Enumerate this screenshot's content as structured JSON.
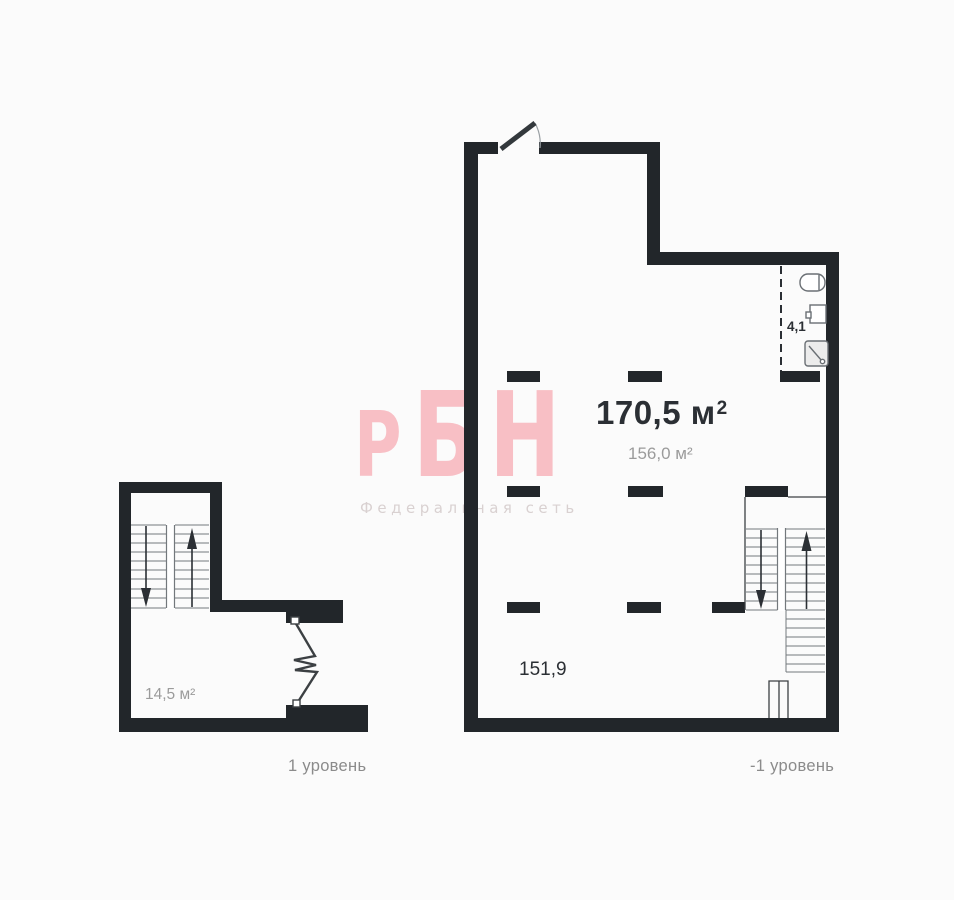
{
  "colors": {
    "background": "#fbfbfb",
    "wall": "#22262a",
    "thin_line": "#3c4043",
    "tread_line": "#73787c",
    "fixture_line": "#6a6f74",
    "fixture_fill": "#ececec",
    "watermark_pink": "#f8bfc5",
    "watermark_gray": "#d9d1d1",
    "label_dark": "#2b2f34",
    "label_gray": "#9b9b9b",
    "caption_gray": "#8b8b8b"
  },
  "watermark": {
    "brand_letters": [
      "Р",
      "Б",
      "Н"
    ],
    "subtitle": "Федеральная сеть"
  },
  "plans": {
    "level1": {
      "caption": "1 уровень",
      "area_label": "14,5 м²"
    },
    "level_minus1": {
      "caption": "-1 уровень",
      "total_area": {
        "value": "170,5 м",
        "sup": "2"
      },
      "secondary_area": "156,0 м²",
      "room_area": "151,9",
      "bathroom_area": "4,1"
    }
  },
  "icons": {
    "door": "door-swing-icon",
    "toilet": "toilet-icon",
    "sink": "sink-icon",
    "shower": "shower-icon",
    "stair_up": "stairs-up-arrow-icon",
    "stair_down": "stairs-down-arrow-icon",
    "break": "stair-break-line-icon"
  }
}
